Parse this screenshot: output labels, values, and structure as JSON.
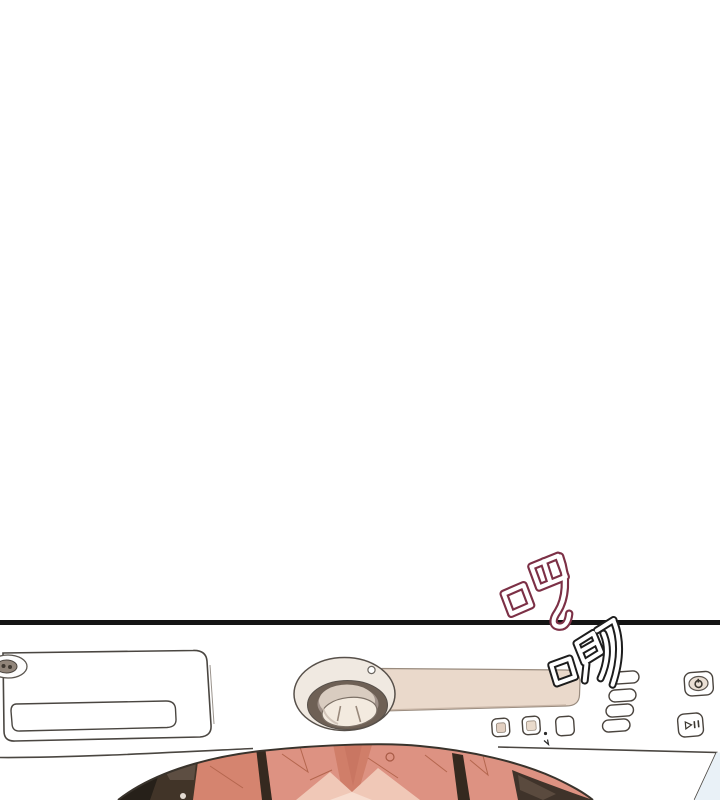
{
  "panel": {
    "background": "#ffffff",
    "border_color": "#141414"
  },
  "sfx": [
    {
      "id": "ba",
      "text": "吧",
      "outline_color": "#7c3046",
      "fill_color": "#ffffff"
    },
    {
      "id": "ji",
      "text": "唧",
      "outline_color": "#1d1d1d",
      "fill_color": "#ffffff"
    }
  ],
  "illustration": {
    "subject": "washing machine top control panel with open drum showing pink laundry",
    "colors": {
      "line_art": "#4a4641",
      "panel_strip": "#ead9cb",
      "panel_strip_edge": "#998b7e",
      "knob_ring_dark": "#6e6055",
      "knob_face": "#f3eadf",
      "knob_base": "#f0e9e1",
      "laundry_pink": "#dd9282",
      "laundry_pink_dark": "#d5846f",
      "laundry_pink_light": "#f0c8b7",
      "drum_rim_dark": "#413428",
      "divider_dark": "#35291f",
      "background_right": "#e9f1f7",
      "button_inner_beige": "#e3d0c1"
    }
  }
}
